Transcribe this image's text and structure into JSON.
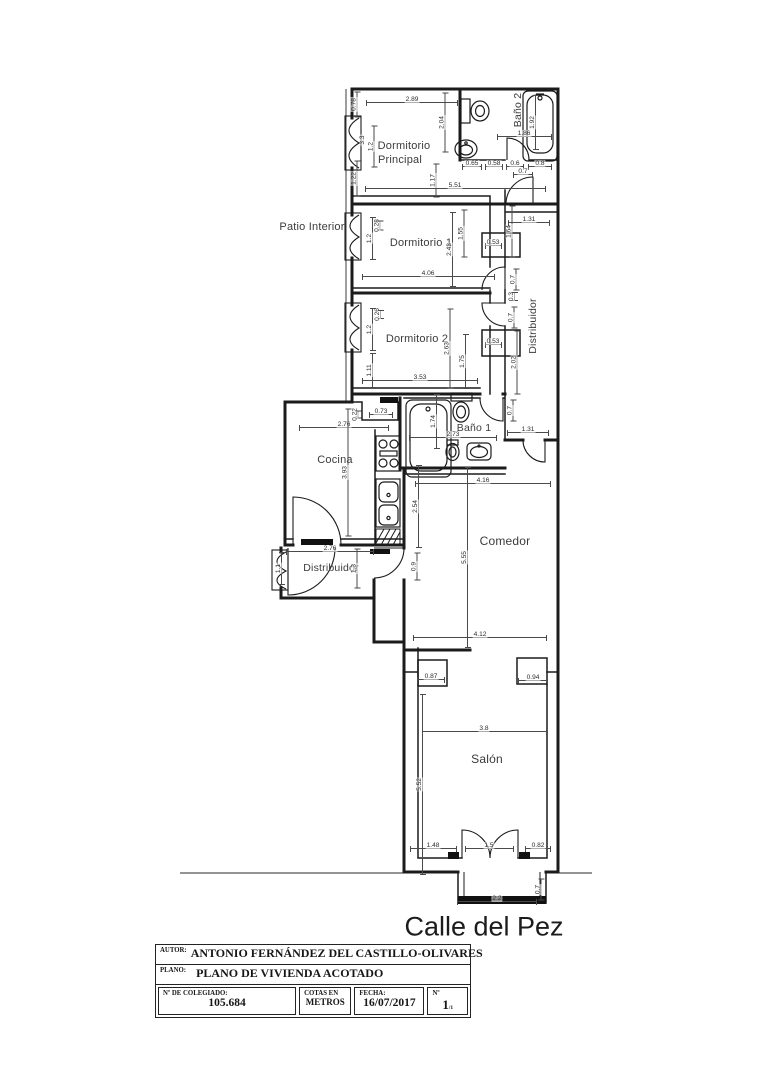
{
  "colors": {
    "ink": "#1f1f1f",
    "dim_line": "#4a4a4a",
    "text": "#2c2c2c"
  },
  "street": {
    "label": "Calle del Pez"
  },
  "plan": {
    "room_labels": [
      {
        "text": "Dormitorio",
        "x": 404,
        "y": 146,
        "rot": 0,
        "size": 11
      },
      {
        "text": "Principal",
        "x": 400,
        "y": 160,
        "rot": 0,
        "size": 11
      },
      {
        "text": "Baño 2",
        "x": 518,
        "y": 110,
        "rot": -90,
        "size": 10.5
      },
      {
        "text": "Patio Interior",
        "x": 312,
        "y": 227,
        "rot": 0,
        "size": 11
      },
      {
        "text": "Dormitorio 1",
        "x": 421,
        "y": 243,
        "rot": 0,
        "size": 11
      },
      {
        "text": "Distribuidor",
        "x": 533,
        "y": 326,
        "rot": -90,
        "size": 10.5
      },
      {
        "text": "Dormitorio 2",
        "x": 417,
        "y": 339,
        "rot": 0,
        "size": 11
      },
      {
        "text": "Baño 1",
        "x": 474,
        "y": 428,
        "rot": 0,
        "size": 10.5
      },
      {
        "text": "Cocina",
        "x": 335,
        "y": 460,
        "rot": 0,
        "size": 11
      },
      {
        "text": "Comedor",
        "x": 505,
        "y": 541,
        "rot": 0,
        "size": 12
      },
      {
        "text": "Distribuidor",
        "x": 331,
        "y": 568,
        "rot": 0,
        "size": 10.5
      },
      {
        "text": "Salón",
        "x": 487,
        "y": 759,
        "rot": 0,
        "size": 12
      }
    ],
    "dimensions": [
      {
        "text": "0.78",
        "x": 357,
        "y": 104,
        "rot": -90,
        "len": 26
      },
      {
        "text": "2.89",
        "x": 412,
        "y": 102,
        "rot": 0,
        "len": 92
      },
      {
        "text": "2.04",
        "x": 445,
        "y": 122,
        "rot": -90,
        "len": 60
      },
      {
        "text": "3.3",
        "x": 366,
        "y": 140,
        "rot": -90,
        "len": 0
      },
      {
        "text": "1.2",
        "x": 374,
        "y": 146,
        "rot": -90,
        "len": 42
      },
      {
        "text": "1.22",
        "x": 357,
        "y": 178,
        "rot": -90,
        "len": 36
      },
      {
        "text": "1.17",
        "x": 436,
        "y": 180,
        "rot": -90,
        "len": 34
      },
      {
        "text": "5.51",
        "x": 455,
        "y": 188,
        "rot": 0,
        "len": 181
      },
      {
        "text": "0.65",
        "x": 472,
        "y": 166,
        "rot": 0,
        "len": 20
      },
      {
        "text": "0.58",
        "x": 494,
        "y": 166,
        "rot": 0,
        "len": 18
      },
      {
        "text": "0.6",
        "x": 515,
        "y": 166,
        "rot": 0,
        "len": 18
      },
      {
        "text": "0.8",
        "x": 540,
        "y": 166,
        "rot": 0,
        "len": 24
      },
      {
        "text": "1.86",
        "x": 524,
        "y": 136,
        "rot": 0,
        "len": 55
      },
      {
        "text": "1.92",
        "x": 535,
        "y": 122,
        "rot": -90,
        "len": 55
      },
      {
        "text": "0.7",
        "x": 523,
        "y": 174,
        "rot": 0,
        "len": 20
      },
      {
        "text": "0.28",
        "x": 380,
        "y": 225,
        "rot": -90,
        "len": 10
      },
      {
        "text": "1.2",
        "x": 372,
        "y": 238,
        "rot": -90,
        "len": 43
      },
      {
        "text": "1.55",
        "x": 464,
        "y": 233,
        "rot": -90,
        "len": 48
      },
      {
        "text": "2.43",
        "x": 452,
        "y": 249,
        "rot": -90,
        "len": 75
      },
      {
        "text": "0.53",
        "x": 493,
        "y": 245,
        "rot": 0,
        "len": 17
      },
      {
        "text": "1.64",
        "x": 512,
        "y": 231,
        "rot": -90,
        "len": 52
      },
      {
        "text": "1.31",
        "x": 529,
        "y": 222,
        "rot": 0,
        "len": 42
      },
      {
        "text": "4.06",
        "x": 428,
        "y": 276,
        "rot": 0,
        "len": 133
      },
      {
        "text": "0.7",
        "x": 516,
        "y": 279,
        "rot": -90,
        "len": 22
      },
      {
        "text": "0.3",
        "x": 514,
        "y": 296,
        "rot": -90,
        "len": 9
      },
      {
        "text": "0.26",
        "x": 380,
        "y": 314,
        "rot": -90,
        "len": 9
      },
      {
        "text": "1.2",
        "x": 372,
        "y": 329,
        "rot": -90,
        "len": 43
      },
      {
        "text": "0.7",
        "x": 514,
        "y": 317,
        "rot": -90,
        "len": 22
      },
      {
        "text": "2.63",
        "x": 450,
        "y": 348,
        "rot": -90,
        "len": 80
      },
      {
        "text": "1.75",
        "x": 465,
        "y": 361,
        "rot": -90,
        "len": 55
      },
      {
        "text": "0.53",
        "x": 493,
        "y": 344,
        "rot": 0,
        "len": 17
      },
      {
        "text": "2.02",
        "x": 517,
        "y": 362,
        "rot": -90,
        "len": 64
      },
      {
        "text": "1.11",
        "x": 372,
        "y": 370,
        "rot": -90,
        "len": 35
      },
      {
        "text": "3.53",
        "x": 420,
        "y": 380,
        "rot": 0,
        "len": 116
      },
      {
        "text": "1.74",
        "x": 436,
        "y": 421,
        "rot": -90,
        "len": 55
      },
      {
        "text": "2.73",
        "x": 453,
        "y": 437,
        "rot": 0,
        "len": 88
      },
      {
        "text": "0.7",
        "x": 513,
        "y": 410,
        "rot": -90,
        "len": 22
      },
      {
        "text": "1.31",
        "x": 528,
        "y": 432,
        "rot": 0,
        "len": 42
      },
      {
        "text": "0.22",
        "x": 358,
        "y": 414,
        "rot": -90,
        "len": 8
      },
      {
        "text": "0.73",
        "x": 381,
        "y": 414,
        "rot": 0,
        "len": 24
      },
      {
        "text": "2.76",
        "x": 344,
        "y": 427,
        "rot": 0,
        "len": 90
      },
      {
        "text": "3.93",
        "x": 348,
        "y": 472,
        "rot": -90,
        "len": 128
      },
      {
        "text": "2.54",
        "x": 418,
        "y": 506,
        "rot": -90,
        "len": 83
      },
      {
        "text": "4.16",
        "x": 483,
        "y": 483,
        "rot": 0,
        "len": 136
      },
      {
        "text": "5.55",
        "x": 467,
        "y": 557,
        "rot": -90,
        "len": 181
      },
      {
        "text": "4.12",
        "x": 480,
        "y": 637,
        "rot": 0,
        "len": 134
      },
      {
        "text": "1.1",
        "x": 281,
        "y": 568,
        "rot": -90,
        "len": 33
      },
      {
        "text": "2.76",
        "x": 330,
        "y": 551,
        "rot": 0,
        "len": 88
      },
      {
        "text": "1.3",
        "x": 357,
        "y": 568,
        "rot": -90,
        "len": 40
      },
      {
        "text": "0.9",
        "x": 417,
        "y": 566,
        "rot": -90,
        "len": 28
      },
      {
        "text": "0.87",
        "x": 431,
        "y": 679,
        "rot": 0,
        "len": 28
      },
      {
        "text": "0.94",
        "x": 533,
        "y": 680,
        "rot": 0,
        "len": 30
      },
      {
        "text": "3.8",
        "x": 484,
        "y": 731,
        "rot": 0,
        "len": 125
      },
      {
        "text": "5.52",
        "x": 422,
        "y": 784,
        "rot": -90,
        "len": 181
      },
      {
        "text": "1.48",
        "x": 433,
        "y": 848,
        "rot": 0,
        "len": 47
      },
      {
        "text": "1.5",
        "x": 489,
        "y": 848,
        "rot": 0,
        "len": 49
      },
      {
        "text": "0.82",
        "x": 538,
        "y": 848,
        "rot": 0,
        "len": 26
      },
      {
        "text": "2.2",
        "x": 497,
        "y": 901,
        "rot": 0,
        "len": 80
      },
      {
        "text": "0.7",
        "x": 541,
        "y": 889,
        "rot": -90,
        "len": 22
      }
    ]
  },
  "title_block": {
    "autor_label": "AUTOR:",
    "autor": "ANTONIO FERNÁNDEZ DEL CASTILLO-OLIVARES",
    "plano_label": "PLANO:",
    "plano": "PLANO DE VIVIENDA ACOTADO",
    "colegiado_label": "Nº DE COLEGIADO:",
    "colegiado": "105.684",
    "cotas_label": "COTAS EN",
    "cotas": "METROS",
    "fecha_label": "FECHA:",
    "fecha": "16/07/2017",
    "numero_label": "Nº",
    "numero": "1",
    "numero_sub": "/1"
  }
}
